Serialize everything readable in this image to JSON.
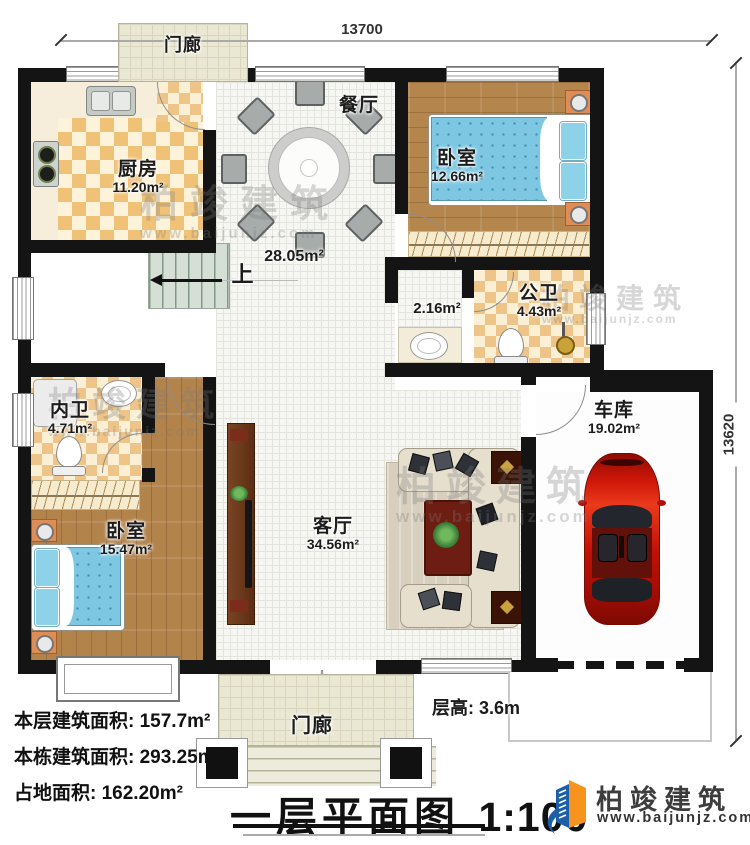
{
  "plan": {
    "dim_top": "13700",
    "dim_right": "13620",
    "floor_height": "层高: 3.6m",
    "stairs_up": "上"
  },
  "rooms": {
    "porch_top": {
      "name": "门廊"
    },
    "kitchen": {
      "name": "厨房",
      "area": "11.20m²"
    },
    "dining": {
      "name": "餐厅"
    },
    "hall": {
      "area": "28.05m²"
    },
    "bedroom_top": {
      "name": "卧室",
      "area": "12.66m²"
    },
    "passage": {
      "area": "2.16m²"
    },
    "public_bath": {
      "name": "公卫",
      "area": "4.43m²"
    },
    "inner_bath": {
      "name": "内卫",
      "area": "4.71m²"
    },
    "bedroom_bottom": {
      "name": "卧室",
      "area": "15.47m²"
    },
    "living": {
      "name": "客厅",
      "area": "34.56m²"
    },
    "garage": {
      "name": "车库",
      "area": "19.02m²"
    },
    "porch_bottom": {
      "name": "门廊"
    }
  },
  "stats": {
    "line1": "本层建筑面积: 157.7m²",
    "line2": "本栋建筑面积: 293.25m²",
    "line3": "占地面积: 162.20m²"
  },
  "title": {
    "text": "一层平面图",
    "scale": "1:100"
  },
  "brand": {
    "name": "柏竣建筑",
    "website": "www.baijunjz.com"
  },
  "colors": {
    "wall": "#141414",
    "tile": "#f0c278",
    "wood": "#b5854e",
    "bed": "#7ec7e2",
    "car": "#cc1409",
    "stair": "#d6dfd6",
    "logo_blue": "#1c5fa8",
    "logo_orange": "#f7941d"
  }
}
